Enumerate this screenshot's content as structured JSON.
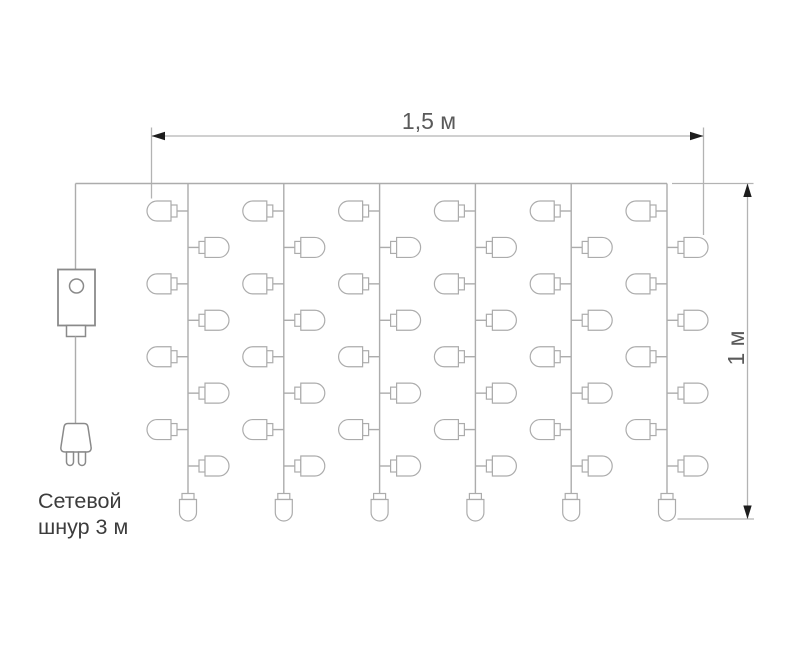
{
  "diagram": {
    "type": "product-spec-curtain-garland",
    "labels": {
      "width": "1,5 м",
      "height": "1 м",
      "cord_line1": "Сетевой",
      "cord_line2": "шнур 3 м"
    },
    "curtain": {
      "strand_count": 6,
      "side_bulbs_per_strand": 8,
      "end_bulbs_per_strand": 1
    },
    "colors": {
      "background": "#ffffff",
      "wire": "#acacac",
      "dimension_line": "#b3b3b3",
      "arrowhead": "#1d1d1d",
      "component_outline": "#8a8a8a",
      "dimension_text": "#5a5a5a",
      "label_text": "#3c3c3c",
      "bulb_fill": "#ffffff"
    }
  }
}
